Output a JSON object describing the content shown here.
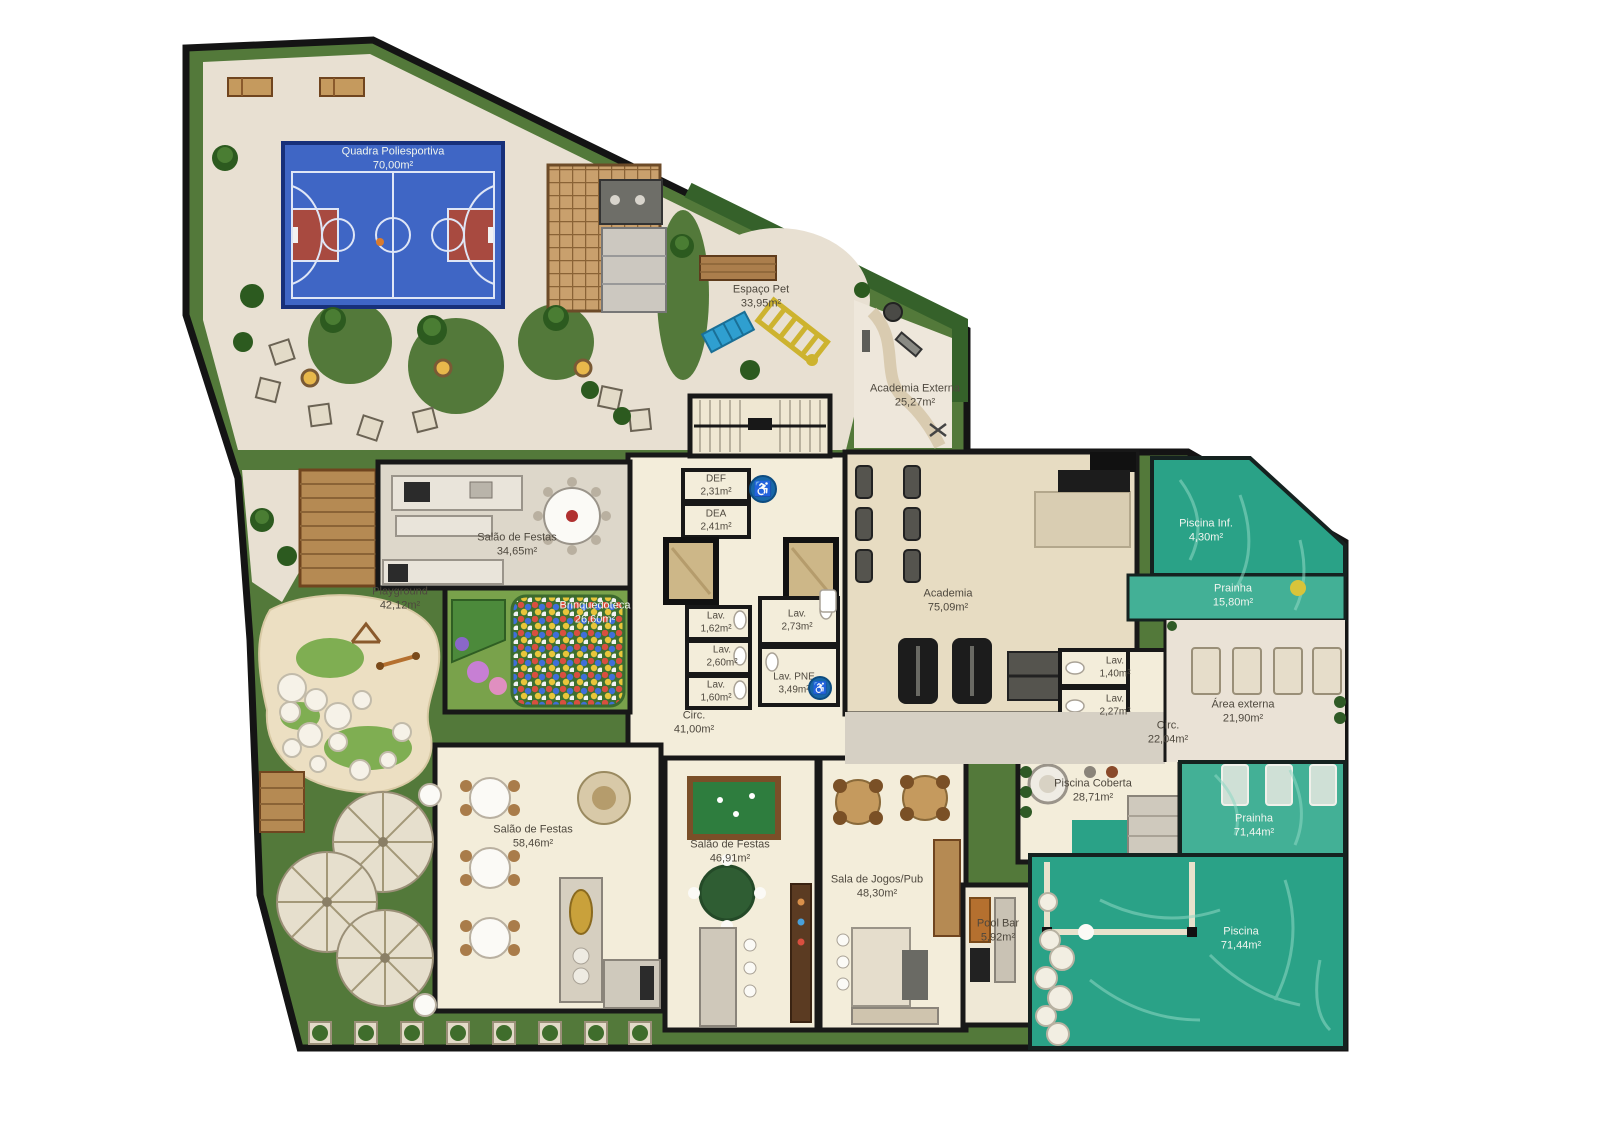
{
  "plan_type": "condominium-common-areas-floor-plan",
  "rooms": [
    {
      "id": "quadra",
      "name": "Quadra Poliesportiva",
      "area": "70,00m²"
    },
    {
      "id": "espaco-pet",
      "name": "Espaço Pet",
      "area": "33,95m²"
    },
    {
      "id": "academia-externa",
      "name": "Academia Externa",
      "area": "25,27m²"
    },
    {
      "id": "salao-festas-1",
      "name": "Salão de Festas",
      "area": "34,65m²"
    },
    {
      "id": "def",
      "name": "DEF",
      "area": "2,31m²"
    },
    {
      "id": "dea",
      "name": "DEA",
      "area": "2,41m²"
    },
    {
      "id": "lav-1",
      "name": "Lav.",
      "area": "1,62m²"
    },
    {
      "id": "lav-2",
      "name": "Lav.",
      "area": "2,60m²"
    },
    {
      "id": "lav-3",
      "name": "Lav.",
      "area": "1,60m²"
    },
    {
      "id": "lav-4",
      "name": "Lav.",
      "area": "2,73m²"
    },
    {
      "id": "lav-pne",
      "name": "Lav. PNE",
      "area": "3,49m²"
    },
    {
      "id": "circ-1",
      "name": "Circ.",
      "area": "41,00m²"
    },
    {
      "id": "academia",
      "name": "Academia",
      "area": "75,09m²"
    },
    {
      "id": "lav-5",
      "name": "Lav.",
      "area": "1,40m²"
    },
    {
      "id": "lav-6",
      "name": "Lav.",
      "area": "2,27m²"
    },
    {
      "id": "circ-2",
      "name": "Circ.",
      "area": "22,04m²"
    },
    {
      "id": "piscina-inf",
      "name": "Piscina Inf.",
      "area": "4,30m²"
    },
    {
      "id": "prainha-1",
      "name": "Prainha",
      "area": "15,80m²"
    },
    {
      "id": "area-externa",
      "name": "Área externa",
      "area": "21,90m²"
    },
    {
      "id": "piscina-coberta",
      "name": "Piscina Coberta",
      "area": "28,71m²"
    },
    {
      "id": "prainha-2",
      "name": "Prainha",
      "area": "71,44m²"
    },
    {
      "id": "piscina",
      "name": "Piscina",
      "area": "71,44m²"
    },
    {
      "id": "playground",
      "name": "Playground",
      "area": "42,12m²"
    },
    {
      "id": "brinquedoteca",
      "name": "Brinquedoteca",
      "area": "26,60m²"
    },
    {
      "id": "salao-festas-2",
      "name": "Salão de Festas",
      "area": "58,46m²"
    },
    {
      "id": "salao-festas-3",
      "name": "Salão de Festas",
      "area": "46,91m²"
    },
    {
      "id": "sala-jogos-pub",
      "name": "Sala de Jogos/Pub",
      "area": "48,30m²"
    },
    {
      "id": "pool-bar",
      "name": "Pool Bar",
      "area": "5,92m²"
    }
  ],
  "icons": {
    "accessible_glyph": "♿"
  },
  "colors": {
    "lawn": "#53793a",
    "paving": "#e8e0d2",
    "court_blue": "#3f66c5",
    "court_key_red": "#a84a40",
    "pool_water": "#2aa287",
    "pool_water_light": "#43b096",
    "interior_floor": "#f3edda",
    "walls": "#181818",
    "wood": "#b58a53",
    "accessible_blue": "#1767a8"
  }
}
